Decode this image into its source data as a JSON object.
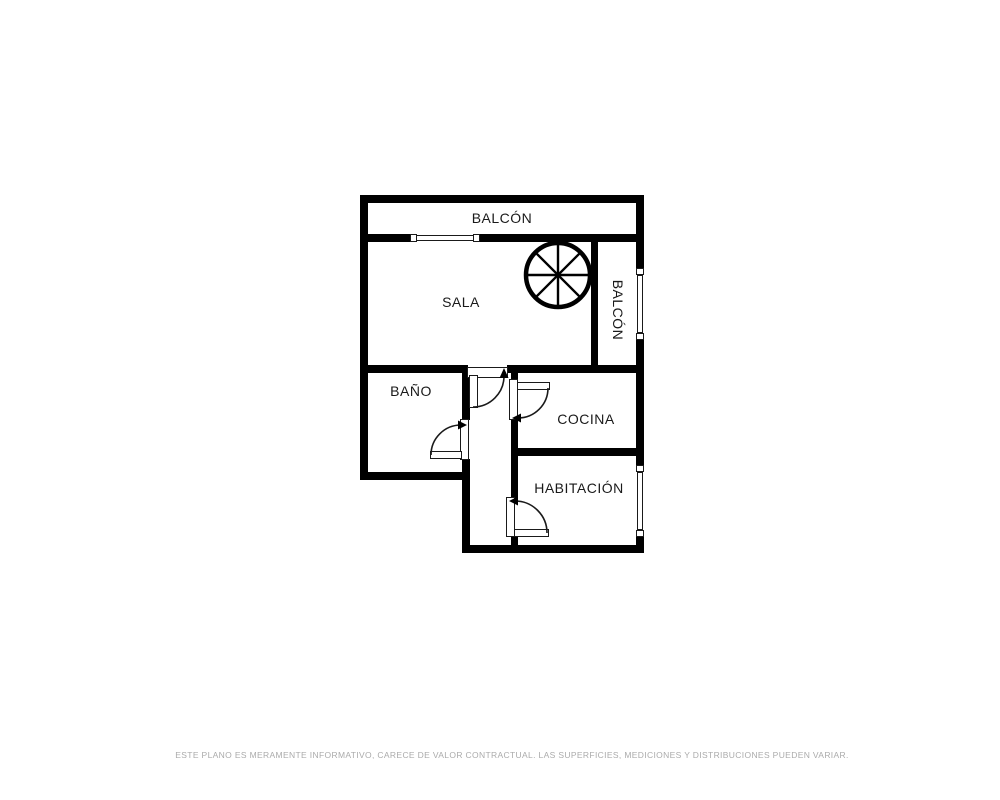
{
  "plan": {
    "title": "floor-plan",
    "rooms": [
      {
        "id": "balcon-top",
        "label": "BALCÓN"
      },
      {
        "id": "sala",
        "label": "SALA"
      },
      {
        "id": "balcon-right",
        "label": "BALCÓN"
      },
      {
        "id": "bano",
        "label": "BAÑO"
      },
      {
        "id": "cocina",
        "label": "COCINA"
      },
      {
        "id": "habitacion",
        "label": "HABITACIÓN"
      }
    ],
    "symbols": {
      "staircase": "spiral-staircase",
      "windows": 3,
      "doors": 4
    }
  },
  "footer": {
    "disclaimer": "ESTE PLANO ES MERAMENTE INFORMATIVO, CARECE DE VALOR CONTRACTUAL. LAS SUPERFICIES, MEDICIONES Y DISTRIBUCIONES PUEDEN VARIAR."
  },
  "colors": {
    "wall": "#000000",
    "background": "#ffffff",
    "label_text": "#1a1a1a",
    "disclaimer_text": "#ababab"
  }
}
